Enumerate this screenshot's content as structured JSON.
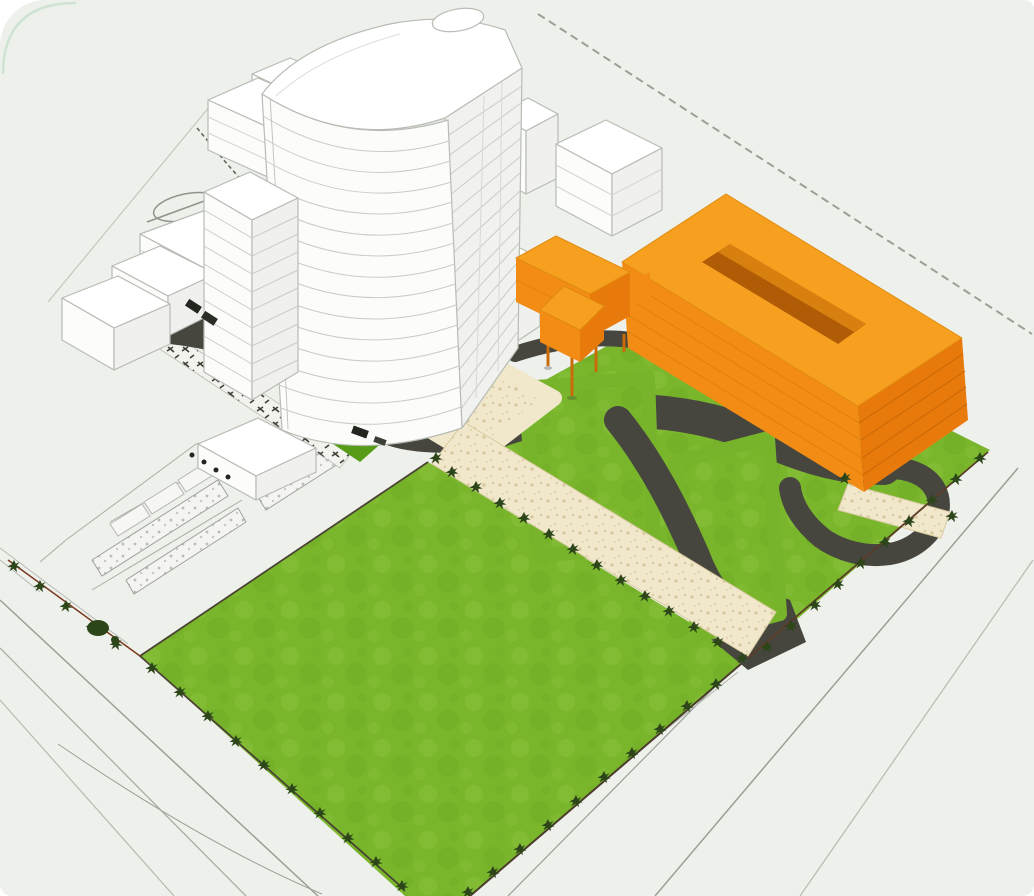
{
  "scene": {
    "description": "Aerial 3D architectural massing rendering of a development site: a curved white high-rise tower and white context buildings on the left, an orange courtyard building with a small orange annex on stilts to the right, large green lawns, rounded lawn islands, dark internal roads, a sand-coloured tree-lined pedestrian path, sketched parking bays and hand-drawn site boundary lines on a pale grey ground.",
    "palette": {
      "background": "#eef0ec",
      "building_white": "#fcfdfb",
      "building_side": "#f0f1ee",
      "building_outline": "#b7bcb4",
      "floor_line": "#c9cdc5",
      "orange_roof": "#f7a01f",
      "orange_front": "#f28c15",
      "orange_end": "#e87a0c",
      "orange_line": "#e2820e",
      "orange_end_line": "#cc6a06",
      "courtyard_shadow": "#b05c06",
      "courtyard_inner": "#d8800f",
      "lawn": "#7ab62c",
      "lawn_texture_light": "#8cc43e",
      "lawn_texture_dark": "#69a822",
      "lawn_dark": "#579c18",
      "road": "#46463e",
      "path": "#f1e7ca",
      "path_dot": "#d9cba1",
      "path_edge": "#d8cba0",
      "tree": "#2c461a",
      "sketch_line": "#9aa098",
      "sketch_light": "#b6bab2",
      "boundary_brown": "#7b3a20",
      "curb": "#4a4334",
      "mark_dark": "#23251f",
      "stipple_dot": "#b9bdb5",
      "corner_accent": "#cfe3d3",
      "stilt": "#c86b08"
    },
    "objects": [
      {
        "id": "high-rise-tower",
        "label": "Curved white high-rise tower"
      },
      {
        "id": "tower-wing",
        "label": "Striped mid-rise wing"
      },
      {
        "id": "context-buildings",
        "label": "White context building blocks"
      },
      {
        "id": "orange-courtyard-building",
        "label": "Orange courtyard building"
      },
      {
        "id": "orange-annex",
        "label": "Orange annex on stilts"
      },
      {
        "id": "great-lawn",
        "label": "Large green lawn"
      },
      {
        "id": "lawn-islands",
        "label": "Rounded lawn islands"
      },
      {
        "id": "internal-roads",
        "label": "Dark internal access roads"
      },
      {
        "id": "tree-lined-path",
        "label": "Sand-coloured tree-lined path"
      },
      {
        "id": "plaza",
        "label": "Sand-coloured plaza"
      },
      {
        "id": "street-trees",
        "label": "Rows of street trees"
      },
      {
        "id": "parking-bays",
        "label": "Sketched parking bays"
      },
      {
        "id": "site-boundary",
        "label": "Sketched site boundary and surrounding roads"
      }
    ]
  }
}
